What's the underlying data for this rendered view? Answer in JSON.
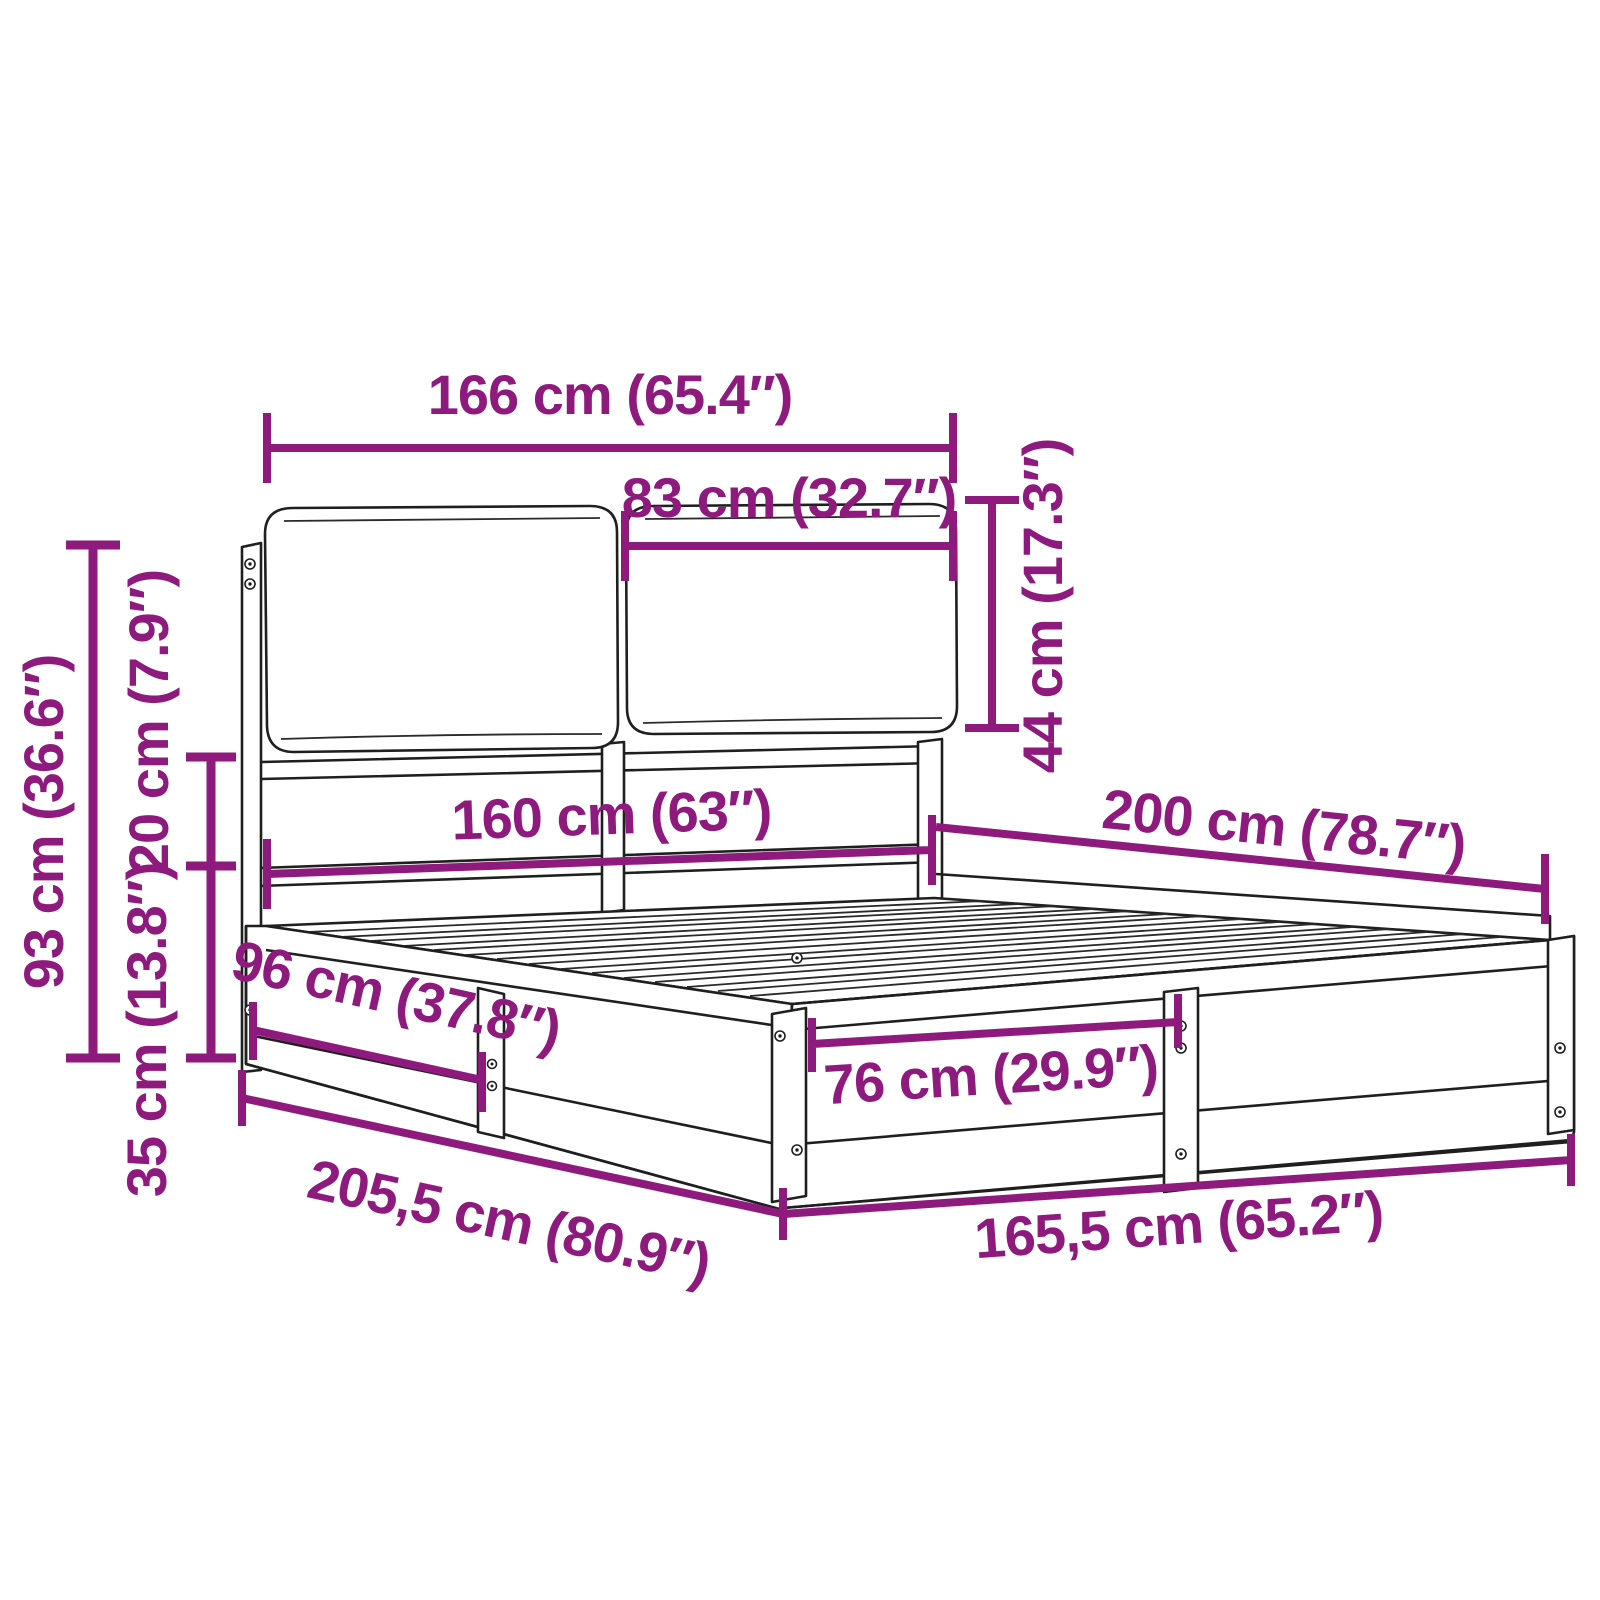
{
  "diagram": {
    "title": "Bed frame dimension diagram",
    "subject": "bed frame with two headboard cushions, slatted base and panel sides",
    "style": "technical line drawing with purple dimension annotations",
    "accent_color": "#8e1a7d",
    "line_color": "#1f1f1f",
    "background_color": "#ffffff",
    "dimensions": [
      {
        "id": "overall-width-top",
        "label": "166 cm (65.4″)",
        "value_cm": "166",
        "value_in": "65.4",
        "orientation": "horizontal"
      },
      {
        "id": "cushion-width",
        "label": "83 cm (32.7″)",
        "value_cm": "83",
        "value_in": "32.7",
        "orientation": "horizontal"
      },
      {
        "id": "cushion-height",
        "label": "44 cm (17.3″)",
        "value_cm": "44",
        "value_in": "17.3",
        "orientation": "vertical"
      },
      {
        "id": "headboard-height",
        "label": "93 cm (36.6″)",
        "value_cm": "93",
        "value_in": "36.6",
        "orientation": "vertical"
      },
      {
        "id": "gap-height",
        "label": "20 cm (7.9″)",
        "value_cm": "20",
        "value_in": "7.9",
        "orientation": "vertical"
      },
      {
        "id": "base-height",
        "label": "35 cm (13.8″)",
        "value_cm": "35",
        "value_in": "13.8",
        "orientation": "vertical"
      },
      {
        "id": "mattress-width",
        "label": "160 cm (63″)",
        "value_cm": "160",
        "value_in": "63",
        "orientation": "horizontal"
      },
      {
        "id": "mattress-length",
        "label": "200 cm (78.7″)",
        "value_cm": "200",
        "value_in": "78.7",
        "orientation": "diagonal"
      },
      {
        "id": "side-section-length",
        "label": "96 cm (37.8″)",
        "value_cm": "96",
        "value_in": "37.8",
        "orientation": "diagonal"
      },
      {
        "id": "overall-length",
        "label": "205,5 cm (80.9″)",
        "value_cm": "205,5",
        "value_in": "80.9",
        "orientation": "diagonal"
      },
      {
        "id": "overall-width-bottom",
        "label": "165,5 cm (65.2″)",
        "value_cm": "165,5",
        "value_in": "65.2",
        "orientation": "diagonal"
      },
      {
        "id": "front-section-width",
        "label": "76 cm (29.9″)",
        "value_cm": "76",
        "value_in": "29.9",
        "orientation": "diagonal"
      }
    ]
  }
}
